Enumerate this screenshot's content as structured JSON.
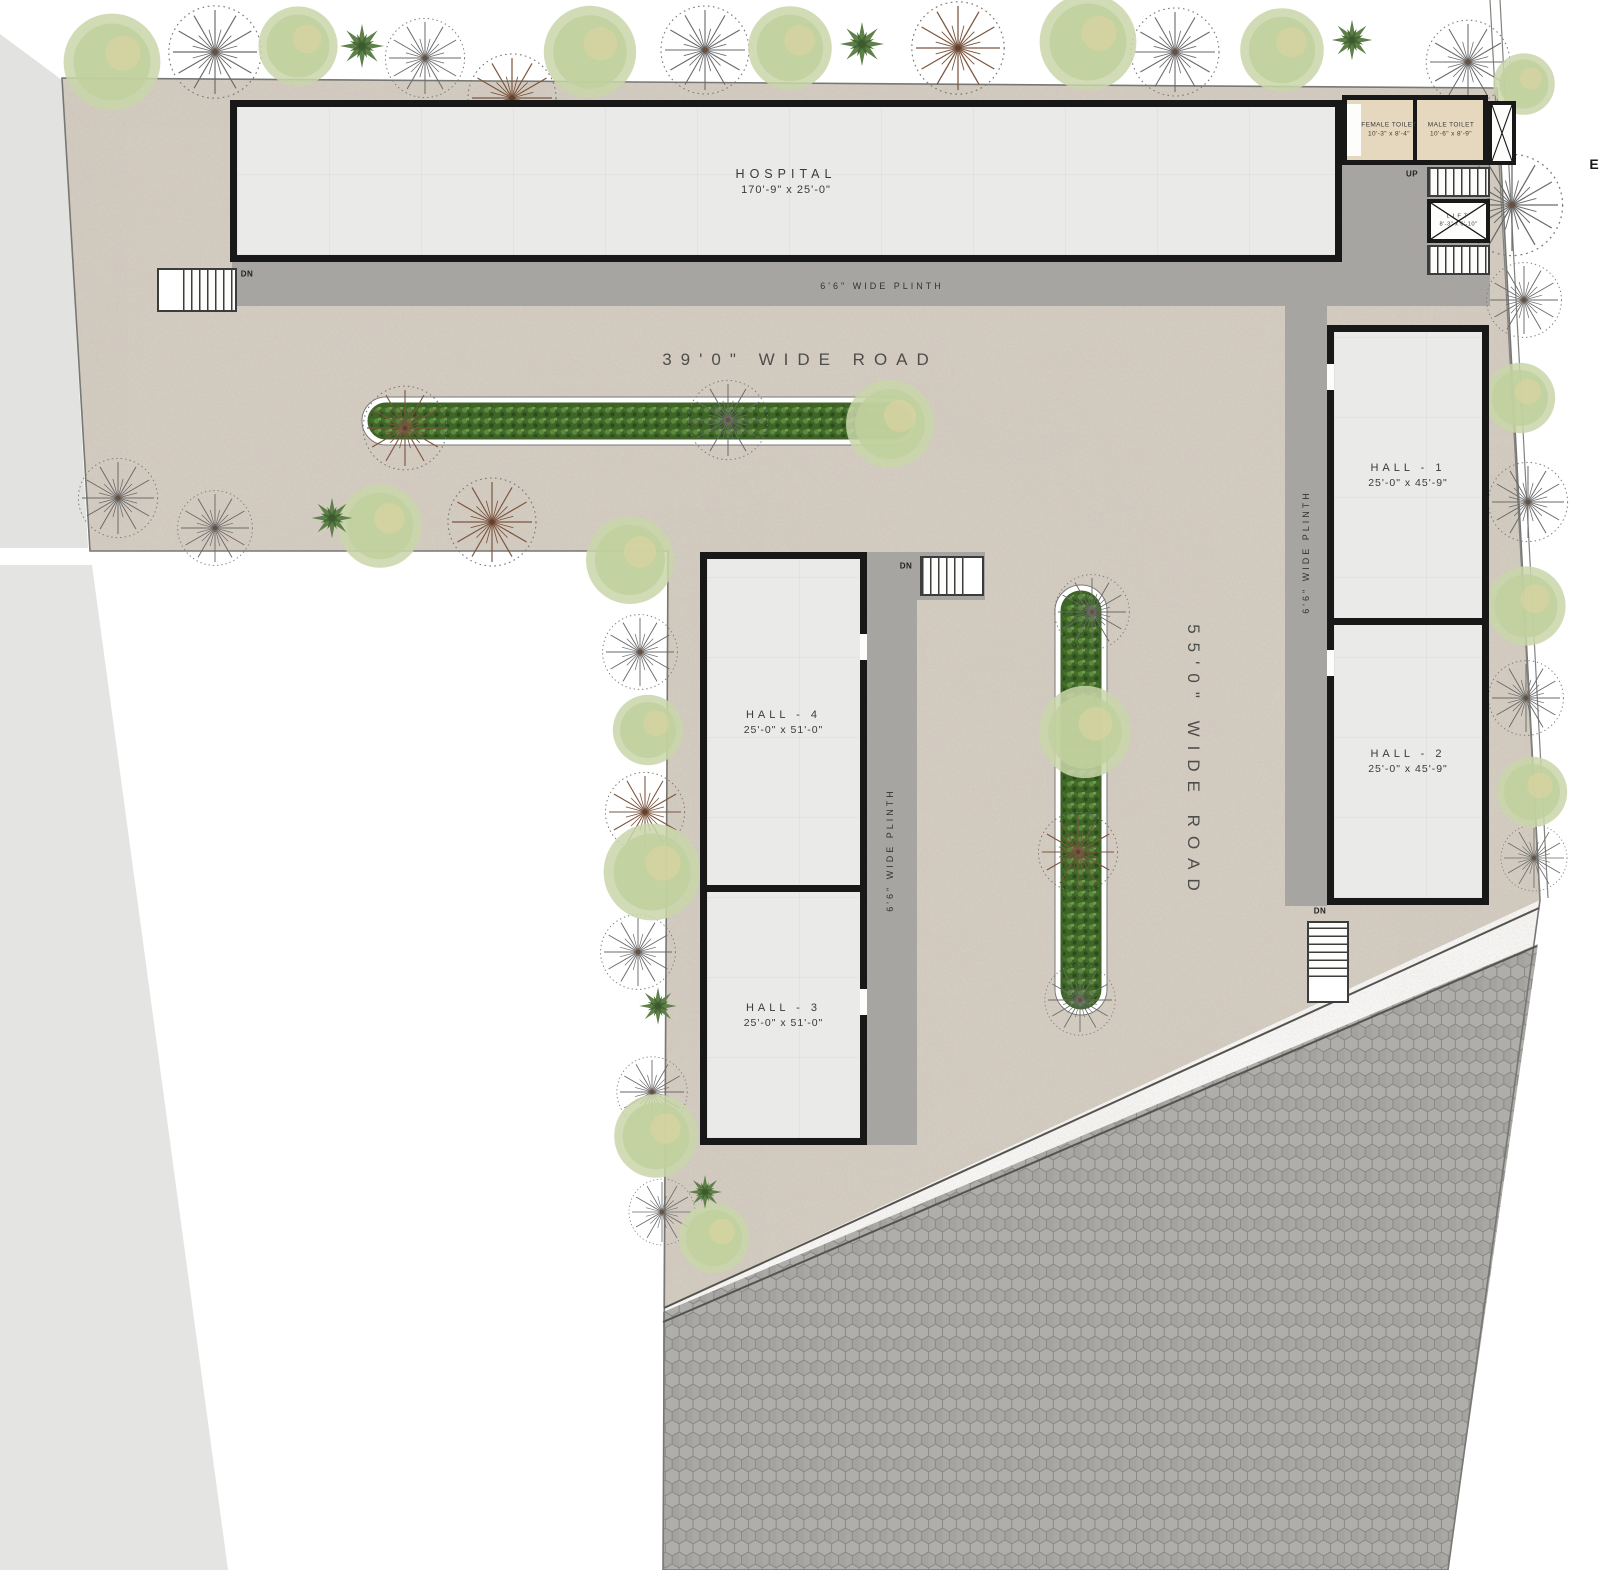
{
  "plan": {
    "hospital": {
      "label": "HOSPITAL",
      "dims": "170'-9\" x 25'-0\""
    },
    "halls": [
      {
        "id": "hall-1",
        "label": "HALL - 1",
        "dims": "25'-0\" x 45'-9\""
      },
      {
        "id": "hall-2",
        "label": "HALL - 2",
        "dims": "25'-0\" x 45'-9\""
      },
      {
        "id": "hall-3",
        "label": "HALL - 3",
        "dims": "25'-0\" x 51'-0\""
      },
      {
        "id": "hall-4",
        "label": "HALL - 4",
        "dims": "25'-0\" x 51'-0\""
      }
    ],
    "toilets": [
      {
        "label": "FEMALE TOILET",
        "dims": "10'-3\" x 8'-4\""
      },
      {
        "label": "MALE TOILET",
        "dims": "10'-6\" x 8'-9\""
      }
    ],
    "lift": {
      "label": "LIFT",
      "dims": "8'-3\" x 6'-10\""
    },
    "roads": [
      {
        "label": "39'0\" WIDE ROAD",
        "orientation": "horizontal"
      },
      {
        "label": "55'0\" WIDE ROAD",
        "orientation": "vertical"
      }
    ],
    "plinth_label": "6'6\" WIDE PLINTH",
    "stairs": {
      "up": "UP",
      "down": "DN"
    },
    "edge_label": "E"
  },
  "icons": {
    "deciduous_tree": "deciduous-tree-icon",
    "canopy_tree": "canopy-tree-icon",
    "palm_tree": "palm-tree-icon"
  },
  "colors": {
    "site_ground": "#d6cec3",
    "plinth_gray": "#a8a6a3",
    "hex_paving": "#a19f9c",
    "building_wall": "#181818",
    "building_floor": "#eaeae8",
    "toilet_floor": "#e6d8bf",
    "median_green": "#3e6527",
    "adjacent_parcel": "#e3e3e1"
  }
}
